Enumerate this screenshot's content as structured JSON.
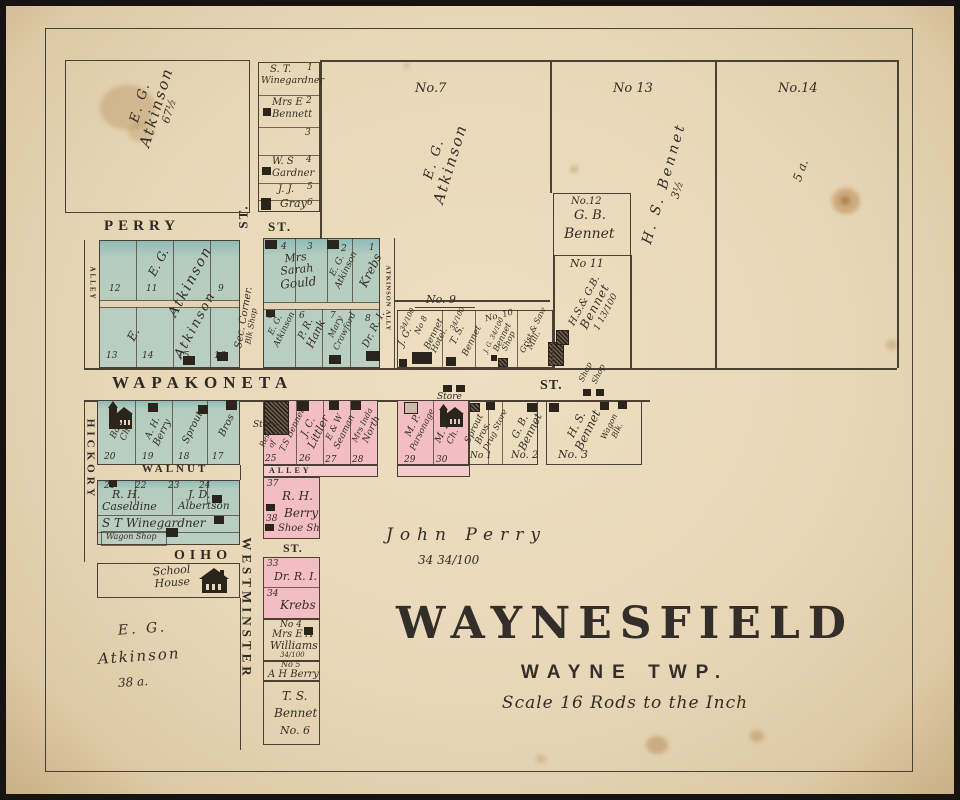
{
  "palette": {
    "paper": "#e8d7b7",
    "green": "#bacfc1",
    "teal": "#8fbcb8",
    "pink": "#f2bec2",
    "ink": "#342d25",
    "line": "#4a4033",
    "building": "#2a241d"
  },
  "map_title": {
    "name": "WAYNESFIELD",
    "township": "WAYNE TWP.",
    "scale": "Scale 16 Rods to the Inch"
  },
  "streets": {
    "perry": "PERRY",
    "perry_st": "ST.",
    "westminster_st_top": "ST.",
    "wapakoneta": "WAPAKONETA",
    "wapakoneta_st": "ST.",
    "walnut": "WALNUT",
    "ohio": "OHIO",
    "ohio_st": "ST.",
    "westminster": "WESTMINSTER",
    "hickory": "HICKORY",
    "alley_west": "ALLEY",
    "atkinson_ally": "ATKINSON ALLY",
    "alley_south": "ALLEY"
  },
  "annotations": {
    "sec_corner": "Sec. Corner.",
    "blk_shop": "Blk Shop",
    "john_perry": "John Perry",
    "john_perry_acreage": "34 34/100",
    "store_north": "Store",
    "store_west": "Store",
    "shop_a": "Shop",
    "shop_b": "Shop",
    "no9_label": "No. 9"
  },
  "outlots": {
    "no7": {
      "label": "No.7",
      "owner1": "E. G.",
      "owner2": "Atkinson"
    },
    "no13": {
      "label": "No 13",
      "owner": "H. S. Bennet",
      "acreage": "3½"
    },
    "no14": {
      "label": "No.14",
      "acreage": "5 a."
    },
    "no12": {
      "label": "No.12",
      "owner1": "G. B.",
      "owner2": "Bennet"
    },
    "no11": {
      "label": "No 11",
      "owner1": "H.S.& G.B.",
      "owner2": "Bennet",
      "acreage": "1 13/100"
    },
    "atkinson_nw": {
      "owner1": "E. G.",
      "owner2": "Atkinson",
      "acreage": "67½"
    },
    "atkinson_sw": {
      "owner1": "E. G.",
      "owner2": "Atkinson",
      "acreage": "38 a."
    }
  },
  "north_lots": [
    {
      "num": "1",
      "l1": "S. T.",
      "l2": "Winegardner"
    },
    {
      "num": "2",
      "l1": "Mrs E",
      "l2": "Bennett"
    },
    {
      "num": "3"
    },
    {
      "num": "4",
      "l1": "W. S",
      "l2": "Gardner"
    },
    {
      "num": "5",
      "l1": "J. J."
    },
    {
      "num": "6",
      "l1": "Gray"
    }
  ],
  "block_nw": {
    "owner_a1": "E. G.",
    "owner_a2": "Atkinson",
    "owner_b1": "E.",
    "owner_b2": "Atkinson",
    "row1_nums": [
      "12",
      "11",
      "9"
    ],
    "row2_nums": [
      "13",
      "14",
      "15",
      "16"
    ]
  },
  "block_gould": {
    "row1_nums": [
      "4",
      "3",
      "2",
      "1"
    ],
    "gould": {
      "l1": "Mrs",
      "l2": "Sarah",
      "l3": "Gould"
    },
    "atkinson": {
      "l1": "E. G.",
      "l2": "Atkinson"
    },
    "krebs": "Krebs",
    "row2": [
      {
        "num": "5",
        "l1": "E. G.",
        "l2": "Atkinson"
      },
      {
        "num": "6",
        "l1": "P. R.",
        "l2": "Hank"
      },
      {
        "num": "7",
        "l1": "Mary",
        "l2": "Crawford"
      },
      {
        "num": "8",
        "l1": "Dr. R. I."
      }
    ]
  },
  "block_no9": {
    "lots": [
      {
        "frac": "34/100",
        "l1": "J. G."
      },
      {
        "num": "No 8",
        "l1": "Bennet",
        "l2": "Hotel."
      },
      {
        "frac": "34/100",
        "l1": "T. S.",
        "l2": "Bennet"
      },
      {
        "num": "No. 10",
        "owner": "J. G. 34/100",
        "l1": "Bennet",
        "l2": "Shop"
      },
      {
        "l1": "Grist & Saw",
        "l2": "Mill."
      }
    ]
  },
  "block_hickory": {
    "lots": [
      {
        "num": "20",
        "l1": "Bap.",
        "l2": "Ch."
      },
      {
        "num": "19",
        "l1": "A. H.",
        "l2": "Berry"
      },
      {
        "num": "18",
        "l1": "Sprout"
      },
      {
        "num": "17",
        "l1": "Bros"
      }
    ]
  },
  "block_walnut": {
    "nums": [
      "21",
      "22",
      "23",
      "24"
    ],
    "caseldine1": "R. H.",
    "caseldine2": "Caseldine",
    "albertson1": "J. D.",
    "albertson2": "Albertson",
    "winegardner": "S T Winegardner",
    "wagon_shop": "Wagon Shop"
  },
  "school": {
    "l1": "School",
    "l2": "House"
  },
  "main_row": {
    "lots": [
      {
        "num": "25",
        "a": "Res",
        "b": "of",
        "c": "T.S Bennet"
      },
      {
        "num": "26",
        "a": "J. C.",
        "b": "Littler"
      },
      {
        "num": "27",
        "a": "E & W",
        "b": "Seaman"
      },
      {
        "num": "28",
        "a": "Mrs Inda",
        "b": "North"
      },
      {
        "num": "29",
        "a": "M. P.",
        "b": "Parsonage"
      },
      {
        "num": "30",
        "a": "M. P.",
        "b": "Ch."
      }
    ]
  },
  "stores": {
    "sprout1": "Sprout",
    "sprout2": "Bros.",
    "sprout_num": "No 1",
    "drug": "Drug Store",
    "gb1": "G. B.",
    "gb2": "Bennet",
    "gb_num": "No. 2",
    "hs1": "H. S.",
    "hs2": "Bennet",
    "hs_num": "No. 3",
    "wagon1": "Wagon",
    "wagon2": "Blk."
  },
  "west_strip": {
    "lot37": {
      "num": "37",
      "name": "R. H."
    },
    "lot38": {
      "num": "38",
      "name": "Berry",
      "shop": "Shoe Sh"
    },
    "lot33": {
      "num": "33",
      "name": "Dr. R. I."
    },
    "lot34": {
      "num": "34",
      "name": "Krebs"
    },
    "no4": {
      "num": "No 4",
      "a": "Mrs E A",
      "b": "Williams",
      "frac": "34/100"
    },
    "no5": {
      "num": "No 5",
      "name": "A H Berry"
    },
    "no6": {
      "a": "T. S.",
      "b": "Bennet",
      "num": "No. 6"
    }
  }
}
